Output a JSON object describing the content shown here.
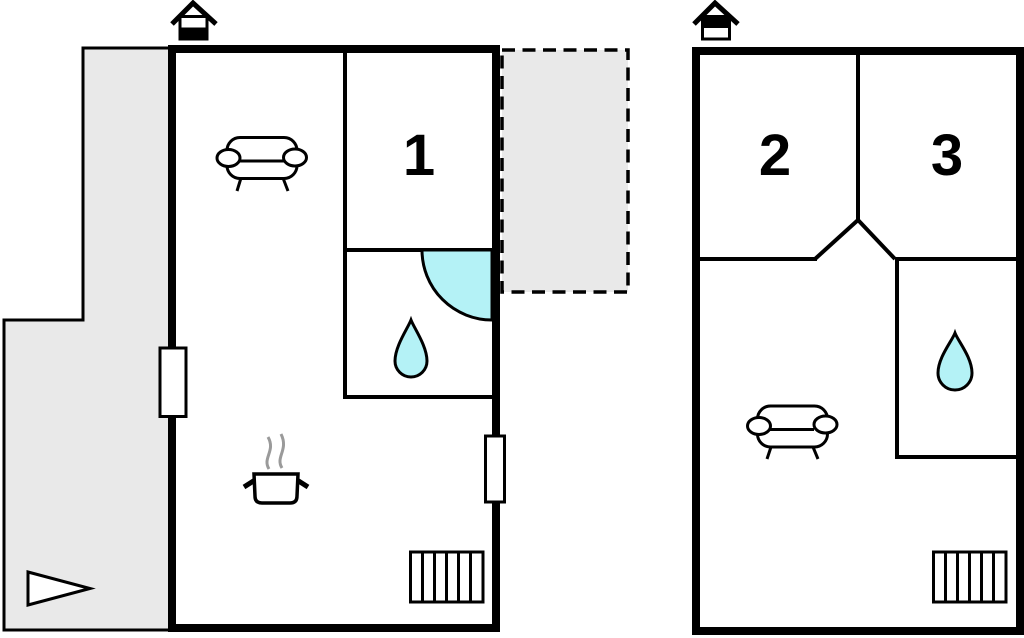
{
  "plan": {
    "type": "floorplan",
    "colors": {
      "wall": "#000000",
      "room_fill": "#ffffff",
      "patio_fill": "#e9e9e9",
      "water_fill": "#b4f2f6",
      "steam": "#9a9a9a",
      "label": "#000000"
    },
    "ground_floor": {
      "rooms": [
        {
          "id": "room-1",
          "label": "1"
        }
      ],
      "icons": [
        "chimney-icon",
        "sofa-icon",
        "stove-icon",
        "shower-door-icon",
        "water-drop-icon",
        "stairs-icon",
        "window",
        "patio-area",
        "terrace-dashed-area",
        "direction-arrow-icon"
      ]
    },
    "upper_floor": {
      "rooms": [
        {
          "id": "room-2",
          "label": "2"
        },
        {
          "id": "room-3",
          "label": "3"
        }
      ],
      "icons": [
        "chimney-icon",
        "sofa-icon",
        "water-drop-icon",
        "stairs-icon"
      ]
    }
  }
}
